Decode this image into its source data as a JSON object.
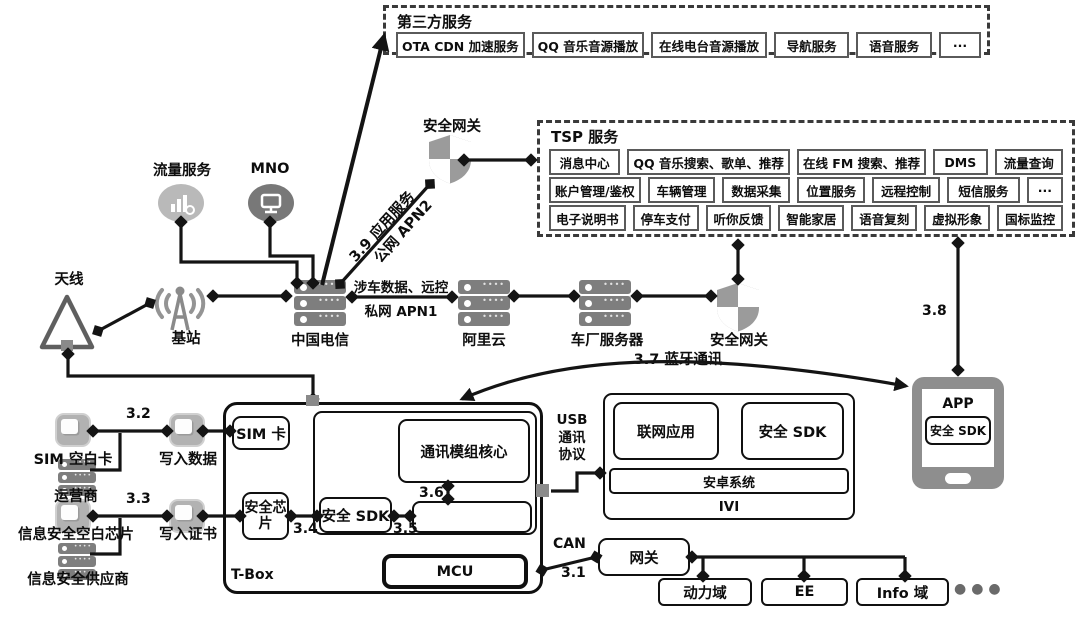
{
  "third_party": {
    "title": "第三方服务",
    "items": [
      "OTA CDN 加速服务",
      "QQ 音乐音源播放",
      "在线电台音源播放",
      "导航服务",
      "语音服务",
      "···"
    ]
  },
  "tsp": {
    "title": "TSP 服务",
    "rows": [
      [
        "消息中心",
        "QQ 音乐搜索、歌单、推荐",
        "在线 FM 搜索、推荐",
        "DMS",
        "流量查询"
      ],
      [
        "账户管理/鉴权",
        "车辆管理",
        "数据采集",
        "位置服务",
        "远程控制",
        "短信服务",
        "···"
      ],
      [
        "电子说明书",
        "停车支付",
        "听你反馈",
        "智能家居",
        "语音复刻",
        "虚拟形象",
        "国标监控"
      ]
    ]
  },
  "cloud": {
    "traffic_service": "流量服务",
    "mno": "MNO",
    "security_gateway_top": "安全网关",
    "antenna": "天线",
    "base_station": "基站",
    "china_telecom": "中国电信",
    "aliyun": "阿里云",
    "oem_server": "车厂服务器",
    "security_gateway": "安全网关"
  },
  "edges": {
    "e39_line1": "3.9 应用服务",
    "e39_line2": "公网 APN2",
    "vehicle_data": "涉车数据、远控",
    "apn1": "私网 APN1",
    "bluetooth": "3.7 蓝牙通讯",
    "e38": "3.8",
    "e32": "3.2",
    "e33": "3.3",
    "e34": "3.4",
    "e35": "3.5",
    "e36": "3.6",
    "e31": "3.1",
    "can": "CAN",
    "usb": "USB\n通讯\n协议"
  },
  "provisioning": {
    "sim_blank": "SIM 空白卡",
    "operator": "运营商",
    "write_data": "写入数据",
    "chip_blank": "信息安全空白芯片",
    "supplier": "信息安全供应商",
    "write_cert": "写入证书"
  },
  "tbox": {
    "label": "T-Box",
    "sim": "SIM 卡",
    "sec_chip": "安全芯片",
    "comm_core": "通讯模组核心",
    "sec_sdk": "安全 SDK",
    "mcu": "MCU"
  },
  "ivi": {
    "label": "IVI",
    "net_app": "联网应用",
    "sec_sdk": "安全 SDK",
    "android": "安卓系统"
  },
  "vehicle": {
    "gateway": "网关",
    "power_domain": "动力域",
    "ee": "EE",
    "info_domain": "Info 域",
    "dots": "●●●"
  },
  "app": {
    "label": "APP",
    "sec_sdk": "安全 SDK"
  },
  "colors": {
    "line": "#141414",
    "icon_gray": "#8f8f8f",
    "icon_dark": "#787878",
    "icon_light": "#b9b9b9"
  }
}
